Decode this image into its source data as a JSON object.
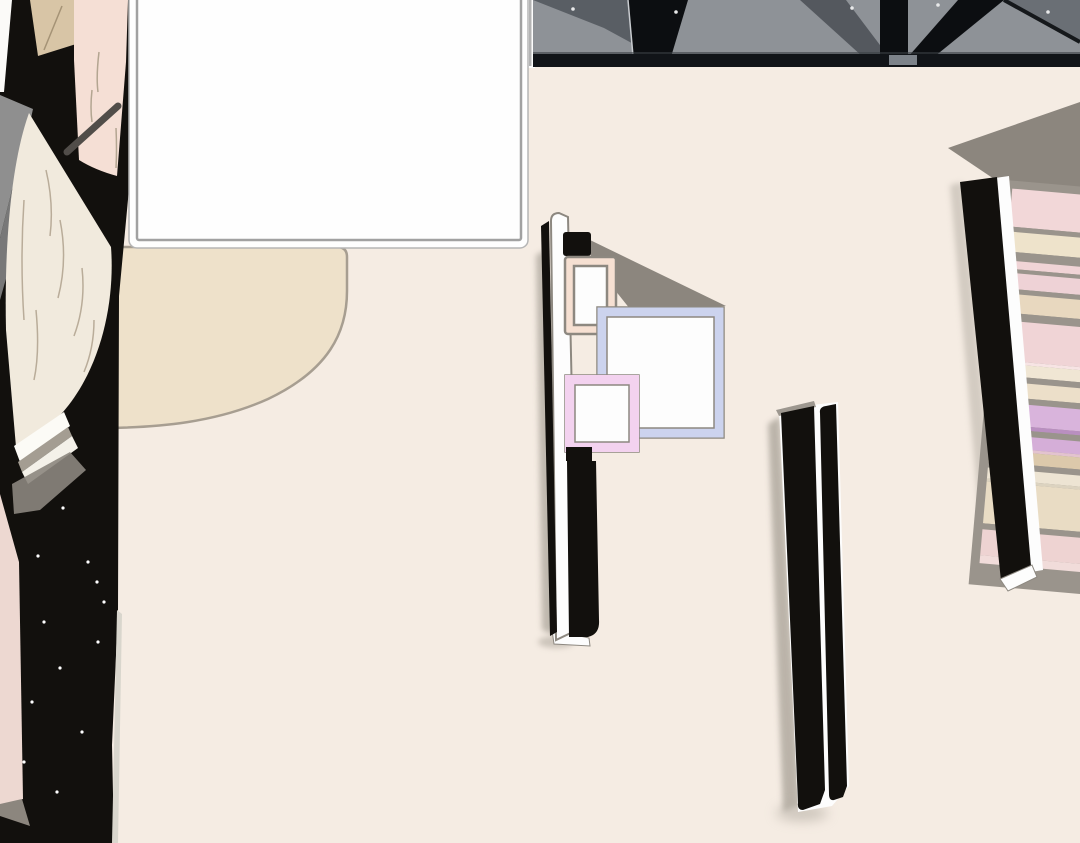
{
  "scene": {
    "type": "webtoon-panel",
    "view": "top-down interior",
    "objects": [
      "blank-speech-panel",
      "ceiling-beams",
      "area-rug",
      "bed-wall-with-frames",
      "partition-wall",
      "bookshelf",
      "book-page-stack",
      "sparkles"
    ]
  },
  "palette": {
    "floor": "#f5ece3",
    "rug": "#eee1ca",
    "rug_line": "#a79e91",
    "white": "#fdfdfd",
    "panel_fill": "#fefefe",
    "panel_border_outer": "#b5b5b5",
    "panel_border_inner": "#a1a1a1",
    "black": "#12100d",
    "ink": "#0c0e11",
    "ceiling_gray": "#8e9297",
    "ceiling_dark": "#595e64",
    "ceiling_band": "#111418",
    "ceiling_tri": "#6a6f75",
    "band_gap": "#7d838a",
    "shadow": "#8c867e",
    "soft_shadow": "#b1aaa0",
    "frame_line": "#8d8880",
    "peach": "#f6e0d2",
    "blue": "#ccd3ee",
    "pink": "#f3d2ef",
    "shelf_rail": "#9a948c",
    "left_tan": "#d8c5a6",
    "left_pink": "#f5dfd5",
    "left_cream": "#f1eadd",
    "page_line": "#b3a591",
    "rod": "#514d49",
    "wedge_gray": "#8f8f8f",
    "wedge_gray2": "#787878",
    "bottom_pink": "#edd8d1",
    "sliver": "#d9d6cd",
    "highlight": "#c9ccd0",
    "dot": "#e8e9ea"
  },
  "speech_panel": {
    "text": ""
  },
  "bookshelf": {
    "rotation_deg": 5,
    "stripes_x": 1013,
    "stripes_top": 188,
    "stripes_width": 227,
    "stripes": [
      {
        "h": 38,
        "c": "#f2d7d8"
      },
      {
        "h": 5,
        "c": "#9a948c"
      },
      {
        "h": 20,
        "c": "#eee3cb"
      },
      {
        "h": 9,
        "c": "#9a948c"
      },
      {
        "h": 8,
        "c": "#f0d4d6"
      },
      {
        "h": 4,
        "c": "#9a948c"
      },
      {
        "h": 16,
        "c": "#eed2d6"
      },
      {
        "h": 5,
        "c": "#9a948c"
      },
      {
        "h": 19,
        "c": "#e8d8bf"
      },
      {
        "h": 8,
        "c": "#9a948c"
      },
      {
        "h": 40,
        "c": "#f0d4d6"
      },
      {
        "h": 3,
        "c": "#f7e4e4"
      },
      {
        "h": 12,
        "c": "#f0e6d4"
      },
      {
        "h": 6,
        "c": "#9a948c"
      },
      {
        "h": 15,
        "c": "#ecdfc9"
      },
      {
        "h": 6,
        "c": "#9a948c"
      },
      {
        "h": 22,
        "c": "#d9b4dc"
      },
      {
        "h": 4,
        "c": "#b98fc0"
      },
      {
        "h": 6,
        "c": "#9a948c"
      },
      {
        "h": 13,
        "c": "#d5aed8"
      },
      {
        "h": 3,
        "c": "#e3c3cf"
      },
      {
        "h": 12,
        "c": "#dcc9ab"
      },
      {
        "h": 6,
        "c": "#9a948c"
      },
      {
        "h": 11,
        "c": "#ede4d3"
      },
      {
        "h": 3,
        "c": "#dcd3c0"
      },
      {
        "h": 42,
        "c": "#e9dcc4"
      },
      {
        "h": 6,
        "c": "#9a948c"
      },
      {
        "h": 26,
        "c": "#eed3d2"
      },
      {
        "h": 8,
        "c": "#f1dcda"
      }
    ]
  },
  "sparkles": [
    [
      63,
      508
    ],
    [
      38,
      556
    ],
    [
      97,
      582
    ],
    [
      44,
      622
    ],
    [
      60,
      668
    ],
    [
      32,
      702
    ],
    [
      98,
      642
    ],
    [
      82,
      732
    ],
    [
      24,
      762
    ],
    [
      57,
      792
    ],
    [
      104,
      602
    ],
    [
      88,
      562
    ]
  ],
  "ceiling_dots": [
    [
      573,
      9
    ],
    [
      676,
      12
    ],
    [
      852,
      8
    ],
    [
      938,
      5
    ],
    [
      1048,
      12
    ]
  ]
}
